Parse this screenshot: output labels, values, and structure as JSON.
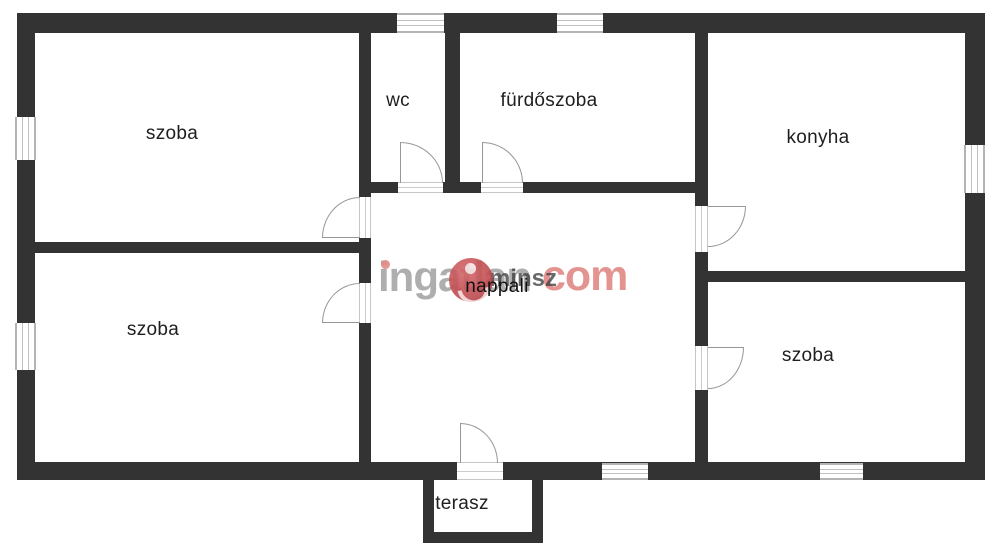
{
  "plan": {
    "rooms": {
      "szoba_tl": {
        "label": "szoba"
      },
      "wc": {
        "label": "wc"
      },
      "furdoszoba": {
        "label": "fürdőszoba"
      },
      "konyha": {
        "label": "konyha"
      },
      "nappali": {
        "label": "nappali"
      },
      "szoba_bl": {
        "label": "szoba"
      },
      "szoba_br": {
        "label": "szoba"
      },
      "terasz": {
        "label": "terasz"
      }
    },
    "watermark": {
      "brand_word": "ingatlan",
      "brand_suffix": "com",
      "overlay_text": "minsz"
    },
    "colors": {
      "wall": "#333333",
      "room_fill": "#ffffff",
      "label_text": "#1e1e1e",
      "door_stroke": "#979797",
      "window_frame": "#b4b4b4",
      "watermark_gray": "#8f8f8f",
      "watermark_pink": "#e0827d",
      "watermark_logo_red": "#c04a4e"
    }
  }
}
